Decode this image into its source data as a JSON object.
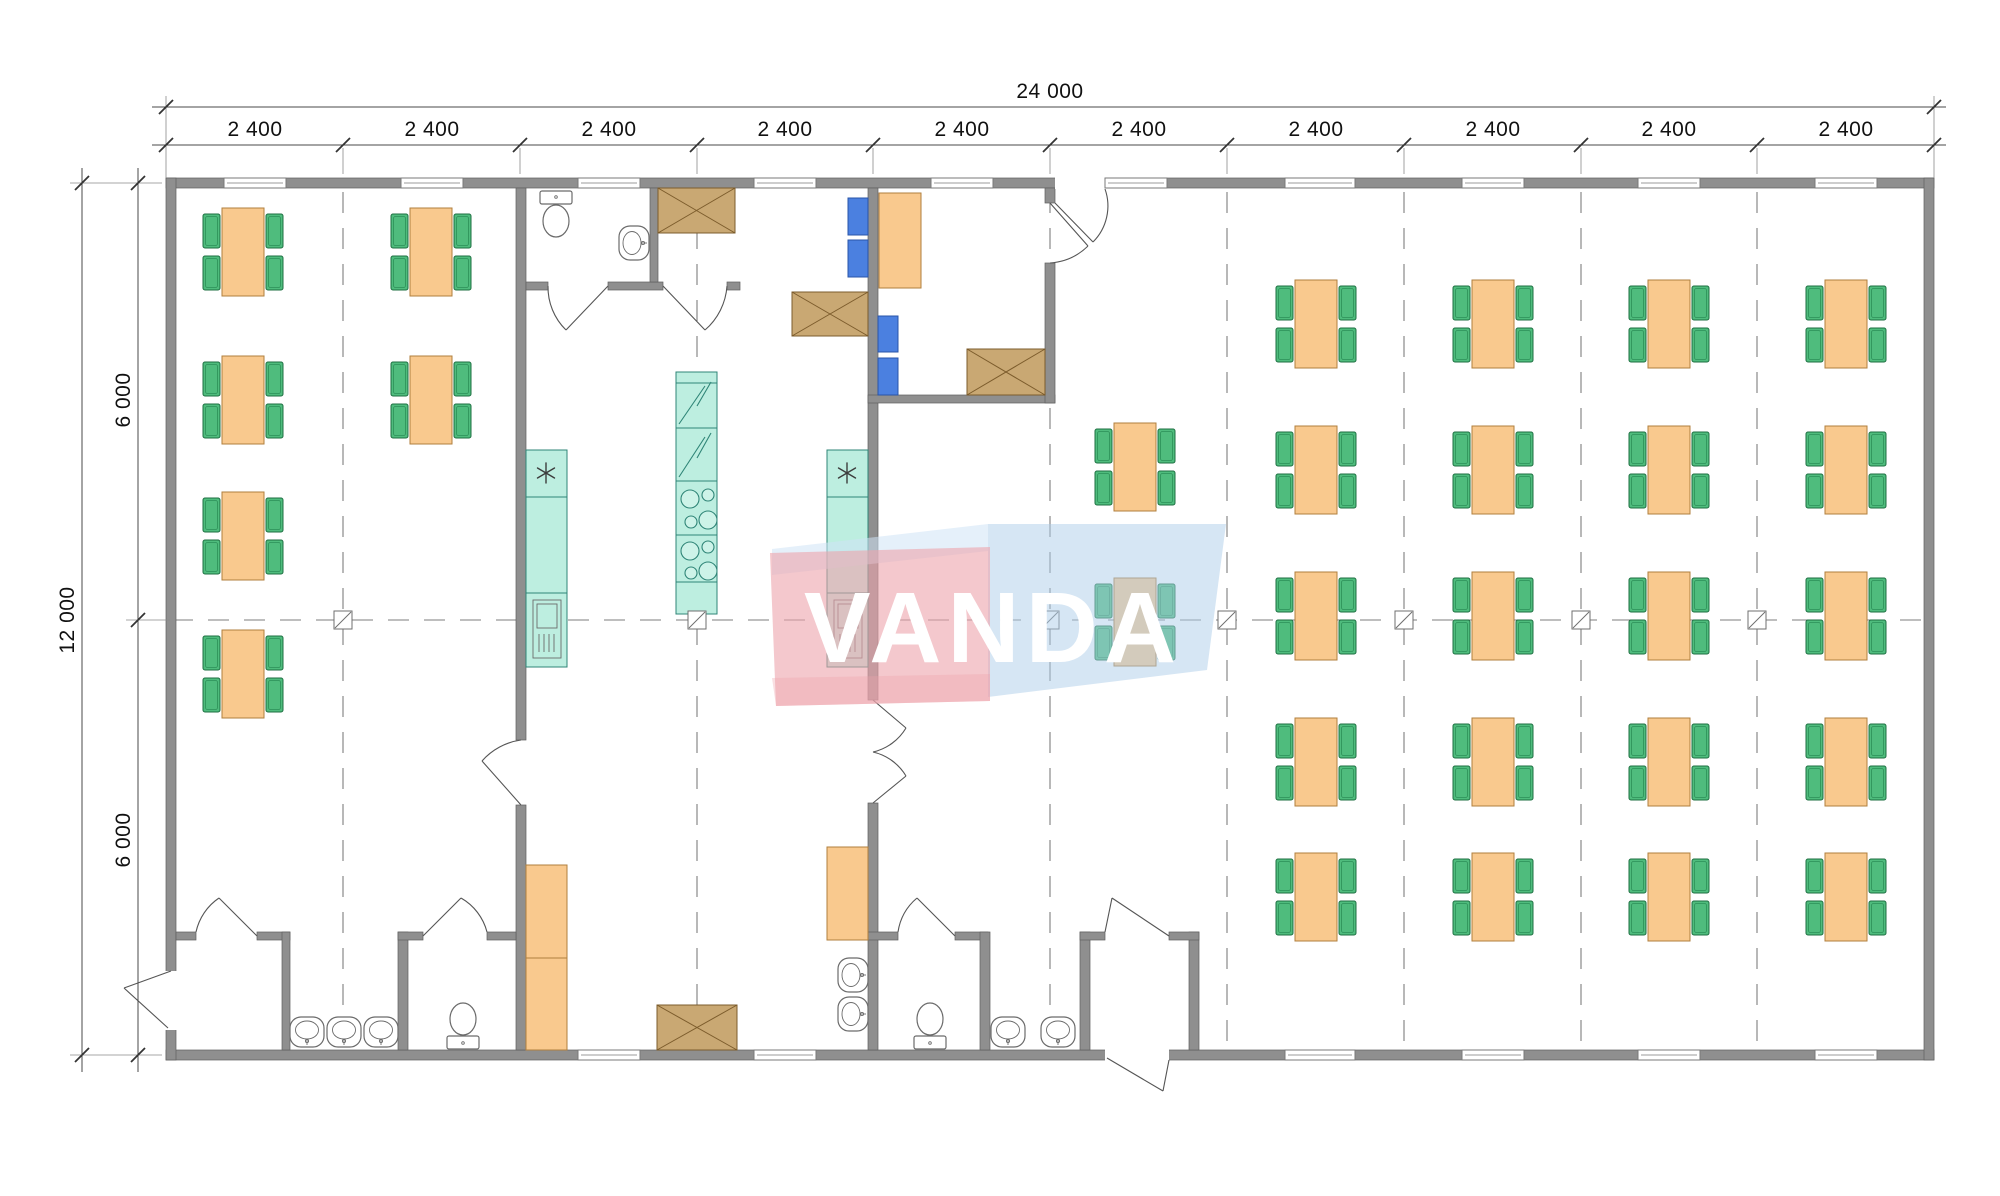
{
  "dimensions": {
    "top_total": "24 000",
    "top_segments": [
      "2 400",
      "2 400",
      "2 400",
      "2 400",
      "2 400",
      "2 400",
      "2 400",
      "2 400",
      "2 400",
      "2 400"
    ],
    "left_total": "12 000",
    "left_segments": [
      "6 000",
      "6 000"
    ]
  },
  "watermark": {
    "text": "VANDA",
    "blue_color": "#aecdea",
    "blue_light_color": "#cfe3f5",
    "red_color": "#eda3ab"
  },
  "palette": {
    "wall_gray": "#8f8f8f",
    "table_orange": "#f9c98e",
    "chair_green": "#4fbc7d",
    "kitchen_teal": "#bdeee0",
    "equipment_brown": "#c9a873",
    "locker_blue": "#4b80e0"
  }
}
